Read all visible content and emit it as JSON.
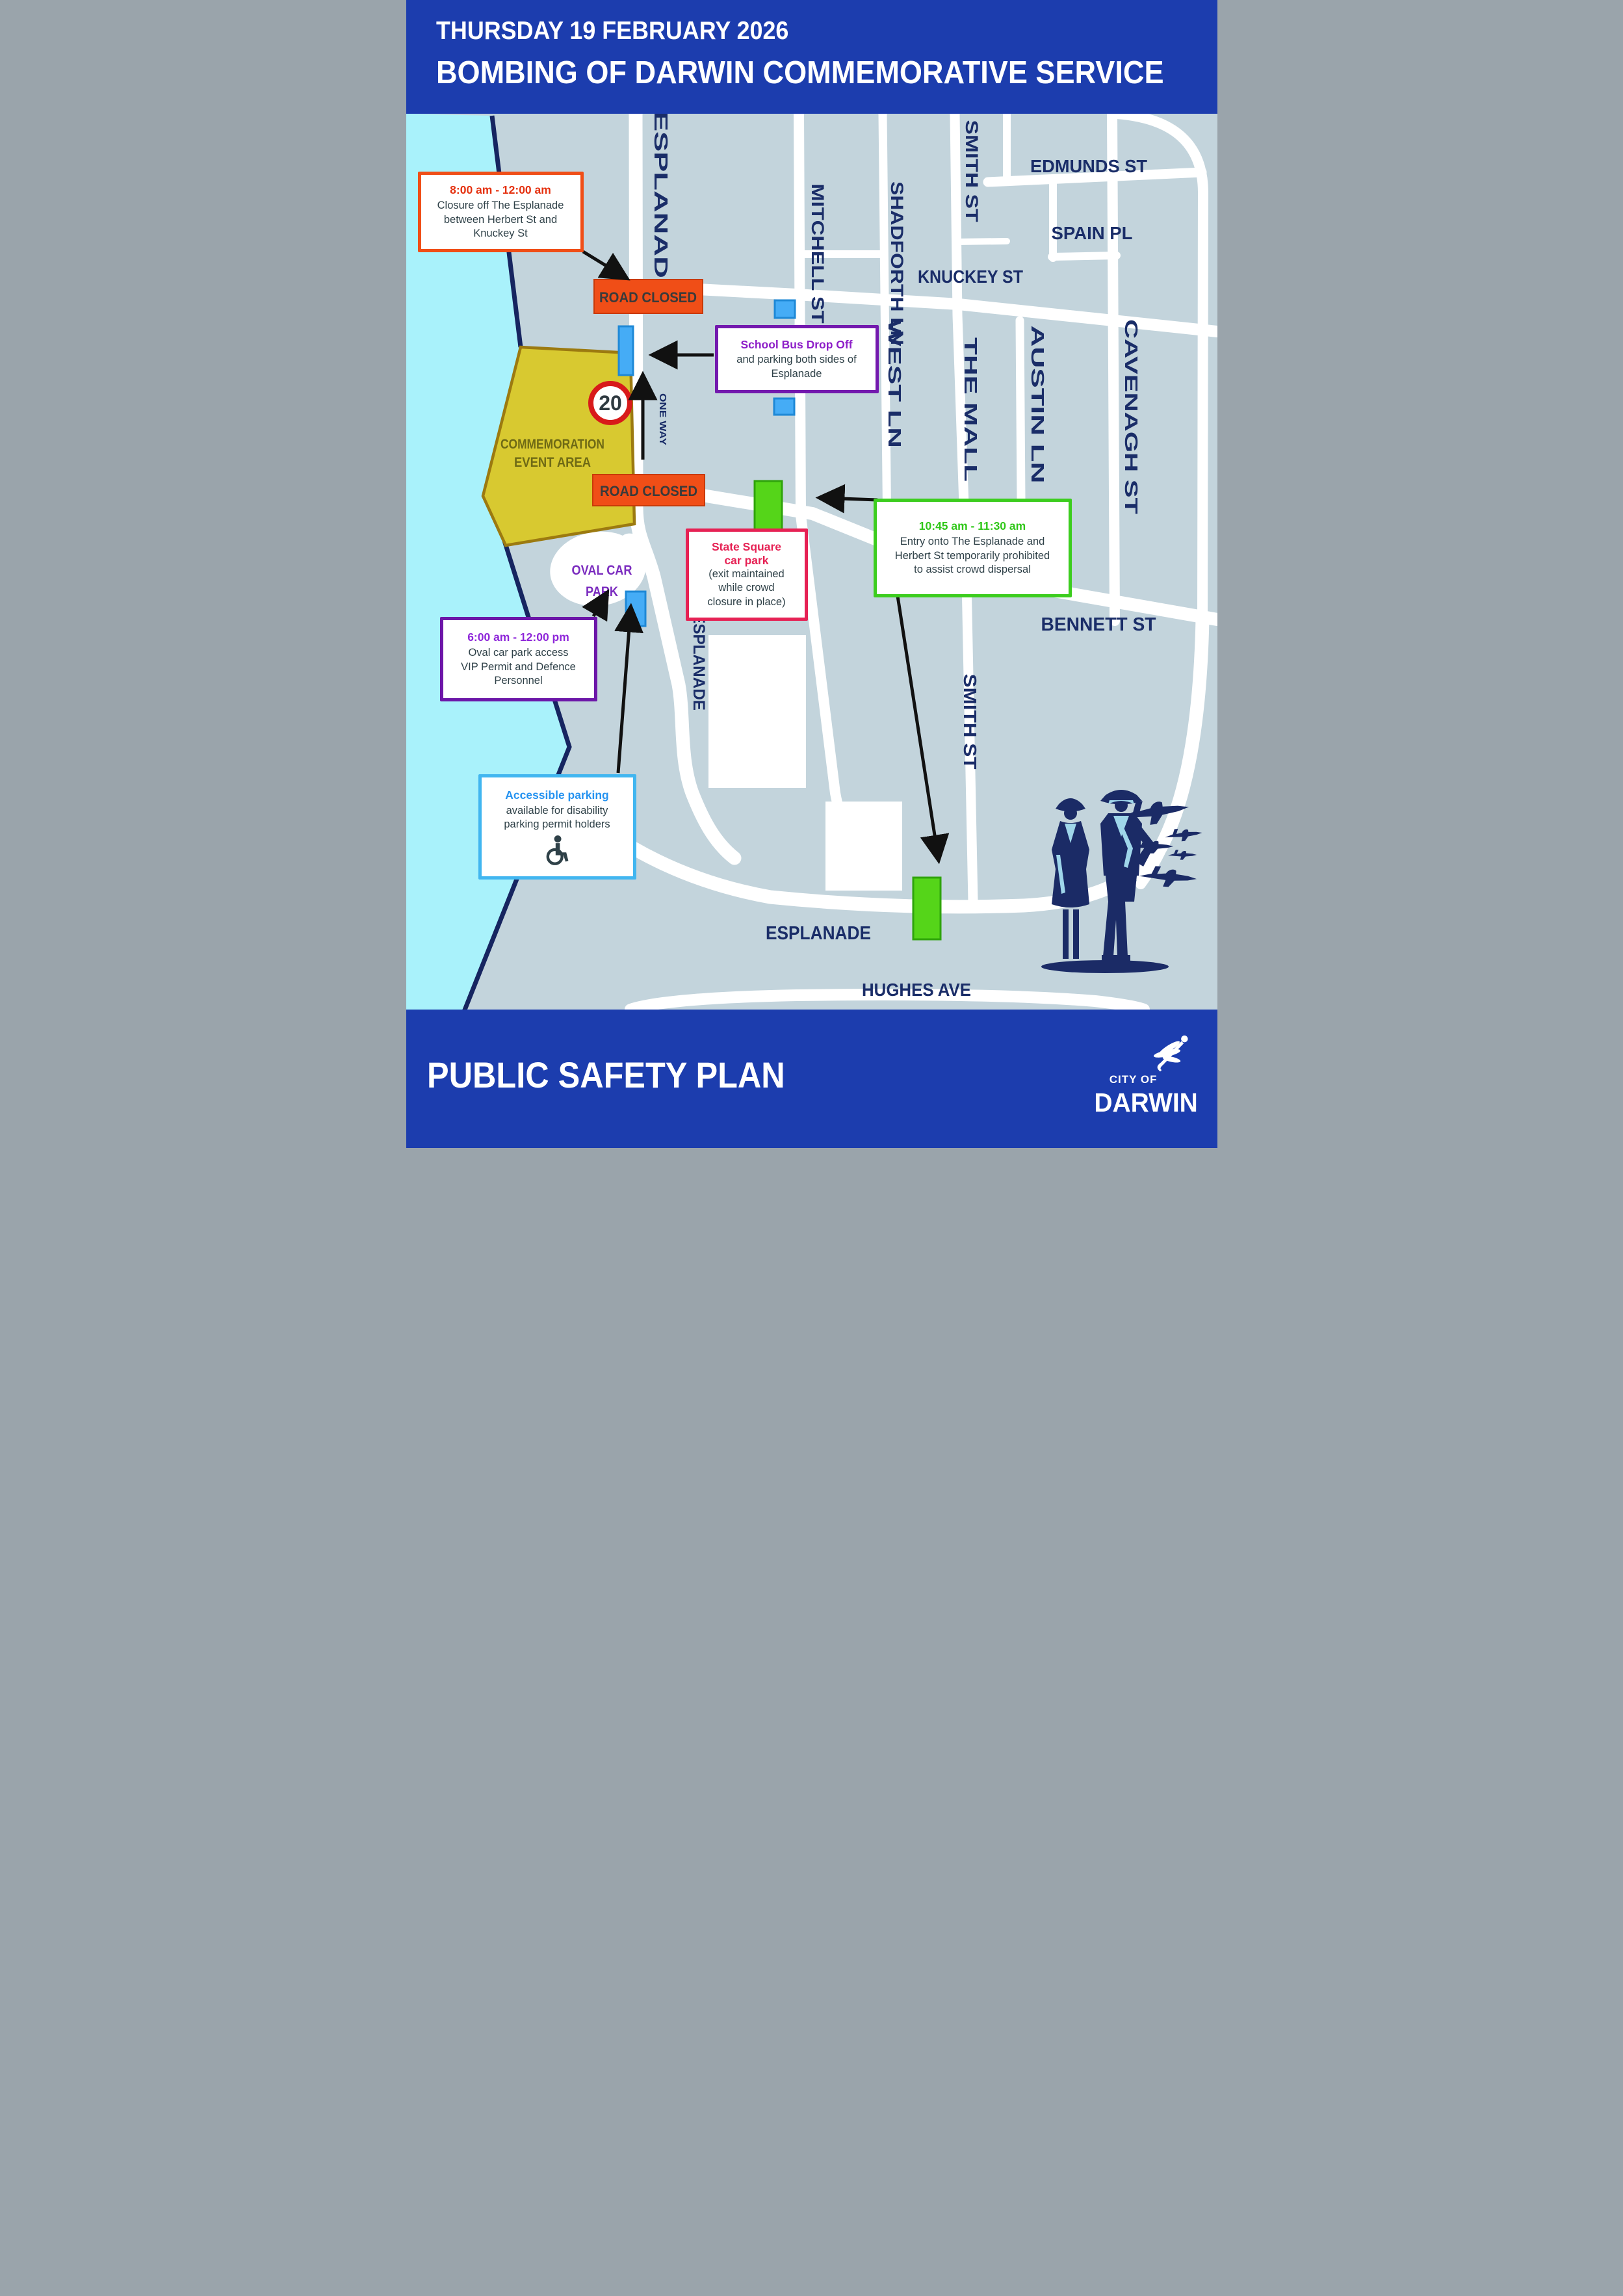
{
  "header": {
    "date": "THURSDAY 19 FEBRUARY 2026",
    "title": "BOMBING OF DARWIN COMMEMORATIVE SERVICE"
  },
  "footer": {
    "title": "PUBLIC SAFETY PLAN",
    "logo": {
      "top": "CITY OF",
      "name": "DARWIN"
    }
  },
  "colors": {
    "banner_blue": "#1C3DAE",
    "land": "#C3D4DC",
    "water": "#A9F2FB",
    "coastline": "#162560",
    "street_label": "#1A2D68",
    "event_area_fill": "#D8C930",
    "event_area_border": "#9C7A10",
    "road_closed_orange": "#F04E17",
    "parking_blue": "#45ACF6",
    "entry_green": "#55D519",
    "purple": "#7319AE",
    "pink": "#E62154",
    "accessible_blue": "#41B6F0",
    "speed_ring_red": "#D81A1A"
  },
  "map": {
    "streets": {
      "esplanade_top": "ESPLANADE",
      "mitchell": "MITCHELL ST",
      "shadforth": "SHADFORTH LN",
      "smith_top": "SMITH ST",
      "edmunds": "EDMUNDS ST",
      "spain": "SPAIN PL",
      "knuckey": "KNUCKEY ST",
      "west_ln": "WEST LN",
      "the_mall": "THE MALL",
      "austin": "AUSTIN LN",
      "cavenagh": "CAVENAGH ST",
      "herbert": "HERBERT ST",
      "bennett": "BENNETT ST",
      "smith_lower": "SMITH ST",
      "esplanade_mid": "ESPLANADE",
      "esplanade_bottom": "ESPLANADE",
      "hughes": "HUGHES AVE"
    },
    "signs": {
      "road_closed": "ROAD CLOSED",
      "speed_limit": "20",
      "one_way": "ONE WAY"
    },
    "labels": {
      "event_area": [
        "COMMEMORATION",
        "EVENT AREA"
      ],
      "oval": [
        "OVAL CAR",
        "PARK"
      ]
    },
    "callouts": {
      "esplanade_closure": {
        "time": "8:00 am - 12:00 am",
        "lines": [
          "Closure off The Esplanade",
          "between Herbert St and",
          "Knuckey St"
        ]
      },
      "school_bus": {
        "title": "School Bus Drop Off",
        "lines": [
          "and parking both sides of",
          "Esplanade"
        ]
      },
      "state_square": {
        "title_lines": [
          "State Square",
          "car park"
        ],
        "lines": [
          "(exit maintained",
          "while crowd",
          "closure in place)"
        ]
      },
      "dispersal": {
        "time": "10:45 am - 11:30 am",
        "lines": [
          "Entry onto The Esplanade and",
          "Herbert St temporarily prohibited",
          "to assist crowd dispersal"
        ]
      },
      "oval_access": {
        "time": "6:00 am - 12:00 pm",
        "lines": [
          "Oval car park access",
          "VIP Permit and Defence",
          "Personnel"
        ]
      },
      "accessible": {
        "title": "Accessible parking",
        "lines": [
          "available for disability",
          "parking permit holders"
        ]
      }
    }
  }
}
